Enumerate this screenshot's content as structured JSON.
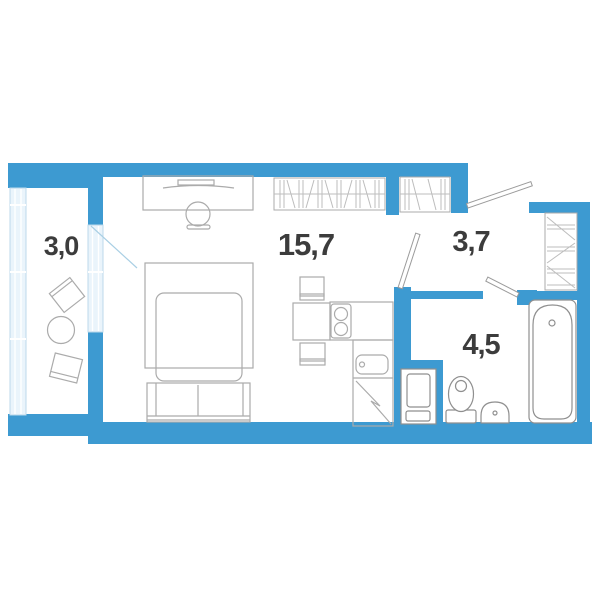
{
  "plan": {
    "type": "apartment-floor-plan",
    "colors": {
      "wall": "#3D9AD1",
      "glazing_fill": "#EAF4FB",
      "glazing_line": "#BCD9EB",
      "furniture_line": "#ABABAB",
      "fixture_line": "#8F8F8F",
      "hatch_line": "#BDBDBD",
      "label_text": "#3C3C3C"
    },
    "rooms": [
      {
        "id": "balcony",
        "area": "3,0"
      },
      {
        "id": "living-room",
        "area": "15,7"
      },
      {
        "id": "hallway",
        "area": "3,7"
      },
      {
        "id": "bathroom",
        "area": "4,5"
      }
    ],
    "fixtures": [
      "bed",
      "sofa",
      "desk",
      "desk-chair",
      "wardrobe",
      "small-wardrobe",
      "hall-closet",
      "kitchen-table",
      "kitchen-chairs",
      "stove",
      "kitchen-sink",
      "fridge",
      "washing-machine",
      "toilet",
      "wash-basin",
      "bathtub",
      "balcony-chairs",
      "balcony-table"
    ]
  }
}
